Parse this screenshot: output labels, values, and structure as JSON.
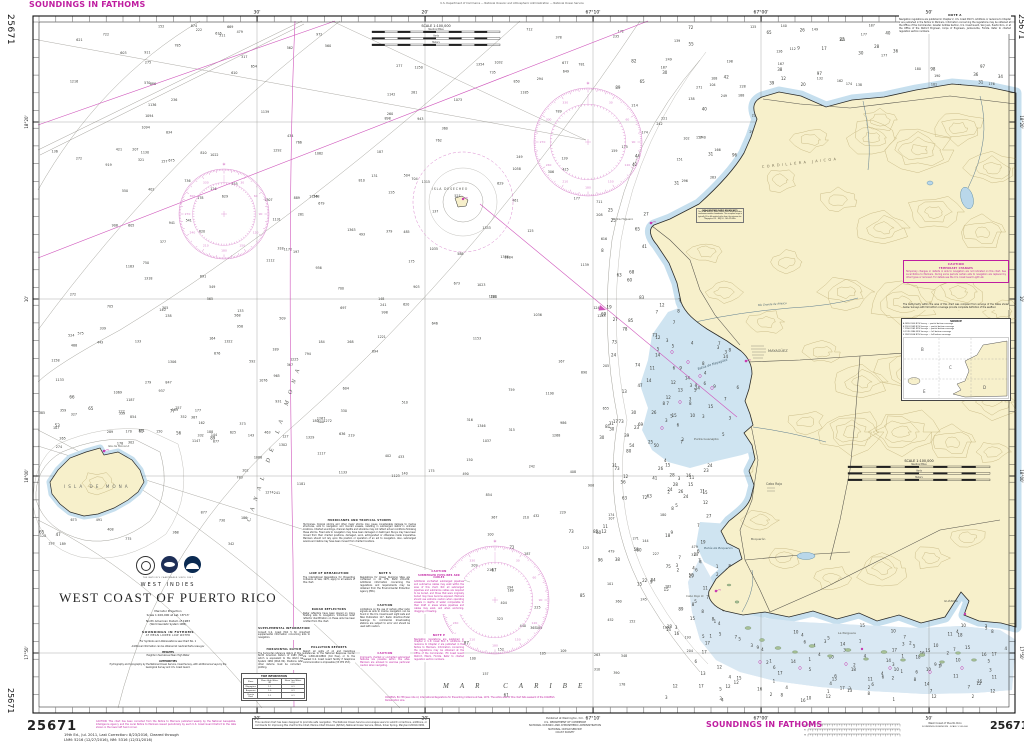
{
  "chart": {
    "number": "25671",
    "soundings_unit_label": "SOUNDINGS IN FATHOMS",
    "top_margin_note": "U.S. Department of Commerce — National Oceanic and Atmospheric Administration — National Ocean Service",
    "edition_note_line1": "19th Ed., Jul. 2011, Last Correction: 8/23/2016, Cleared through",
    "edition_note_line2": "LNM: 5216 (12/27/2016), NM: 5316 (12/31/2016)",
    "bottom_caution": "CAUTION: This chart has been corrected from the Notice to Mariners published weekly by the National Geospatial-Intelligence Agency and the Local Notice to Mariners issued periodically by each U.S. Coast Guard District to the date shown in the lower left hand corner.",
    "user_note": "This nautical chart has been designed to promote safe navigation. The National Ocean Service encourages users to submit corrections, additions, or comments for improving this chart to the Chief, Marine Chart Division (N/CS2), National Ocean Service, NOAA, Silver Spring, Maryland 20910-3282.",
    "publisher_line1": "Published at Washington, D.C.",
    "publisher_line2": "U.S. DEPARTMENT OF COMMERCE",
    "publisher_line3": "NATIONAL OCEANIC AND ATMOSPHERIC ADMINISTRATION",
    "publisher_line4": "NATIONAL OCEAN SERVICE",
    "publisher_line5": "COAST SURVEY",
    "bottom_right_title": "West Coast of Puerto Rico",
    "bottom_right_subtitle": "SOUNDINGS IN FATHOMS · SCALE 1:100,000"
  },
  "title_block": {
    "region": "WEST INDIES",
    "title": "WEST COAST OF PUERTO RICO",
    "projection": "Mercator Projection",
    "scale": "Scale 1:100,000 at Lat. 18°13'",
    "datum": "North American Datum of 1983",
    "datum2": "(World Geodetic System 1984)",
    "soundings": "SOUNDINGS IN FATHOMS",
    "soundings2": "AT MEAN LOWER LOW WATER",
    "symbols_note": "For Symbols and Abbreviations see Chart No. 1",
    "info_note": "Additional information can be obtained at nauticalcharts.noaa.gov",
    "heights_title": "HEIGHTS",
    "heights_text": "Heights in feet above Mean High Water",
    "authorities_title": "AUTHORITIES",
    "authorities_text": "Hydrography and topography by the National Ocean Service, Coast Survey, with additional surveys by the Geological Survey and U.S. Coast Guard.",
    "tagline": "THE NATION'S CHARTMAKER SINCE 1807"
  },
  "geo_labels": {
    "canal": "CANAL DE LA MONA",
    "sea": "MAR CARIBE",
    "mona_island": "ISLA DE MONA",
    "desecheo": "ISLA DESECHEO",
    "cordillera": "CORDILLERA JAICOA",
    "mayaguez_bay": "Bahía de Mayagüez",
    "boqueron_bay": "Bahía de Boquerón",
    "anasco_river": "Río Grande de Añasco",
    "mayaguez_city": "MAYAGÜEZ",
    "cabo_rojo_town": "Cabo Rojo",
    "boqueron_town": "Boquerón",
    "la_parguera": "La Parguera",
    "guanica": "GUÁNICA",
    "punta_higuero": "Punta Higuero",
    "punta_guanajibo": "Punta Guanajibo",
    "mona_light": "Isla de Mona Lt",
    "cabo_rojo_light": "Cabo Rojo Lt"
  },
  "graduation": {
    "top": [
      {
        "x": 257,
        "label": "30'"
      },
      {
        "x": 425,
        "label": "20'"
      },
      {
        "x": 593,
        "label": "67°10'"
      },
      {
        "x": 761,
        "label": "67°00'"
      },
      {
        "x": 929,
        "label": "50'"
      }
    ],
    "bottom": [
      {
        "x": 257,
        "label": "30'"
      },
      {
        "x": 425,
        "label": "20'"
      },
      {
        "x": 593,
        "label": "67°10'"
      },
      {
        "x": 761,
        "label": "67°00'"
      },
      {
        "x": 929,
        "label": "50'"
      }
    ],
    "left": [
      {
        "y": 122,
        "label": "18°20'"
      },
      {
        "y": 299,
        "label": "10'"
      },
      {
        "y": 476,
        "label": "18°00'"
      },
      {
        "y": 653,
        "label": "17°50'"
      }
    ],
    "right": [
      {
        "y": 122,
        "label": "18°20'"
      },
      {
        "y": 299,
        "label": "10'"
      },
      {
        "y": 476,
        "label": "18°00'"
      },
      {
        "y": 653,
        "label": "17°50'"
      }
    ]
  },
  "scale_bar": {
    "title": "SCALE 1:100,000",
    "rows": [
      "Nautical Miles",
      "Yards",
      "Meters"
    ]
  },
  "note_a": {
    "title": "NOTE A",
    "text": "Navigation regulations are published in Chapter 2, U.S. Coast Pilot 5. Additions or revisions to Chapter 2 are published in the Notice to Mariners. Information concerning the regulations may be obtained at the Office of the Commander, Greater Antilles Section, U.S. Coast Guard, San Juan, Puerto Rico, or at the Office of the District Engineer, Corps of Engineers, Jacksonville, Florida. Refer to charted regulation section numbers."
  },
  "caution_box": {
    "title": "CAUTION",
    "subtitle": "TEMPORARY CHANGES",
    "text": "Temporary changes or defects in aids to navigation are not indicated on this chart. See Local Notice to Mariners. During some periods certain aids to navigation are replaced by other types or removed. For details see the U.S. Coast Guard Light List."
  },
  "source_note": "The bathymetry within the area of this chart was compiled from surveys of the dates shown below. Surveys with full bottom coverage provide complete definition of the seafloor.",
  "source_diagram": {
    "title": "SOURCE",
    "entries": [
      "A   1899-1900   NOS Survey — partial bottom coverage",
      "B   1901-1949   NOS Surveys — partial bottom coverage",
      "C   1950-1969   NOS Surveys — partial bottom coverage",
      "D   1970-1986   NOS Surveys — full bottom coverage",
      "E   1987-2004   NOS Surveys — full bottom coverage"
    ]
  },
  "supplemental": {
    "title": "SUPPLEMENTAL INFORMATION",
    "text": "Consult U.S. Coast Pilot 5 for important supplemental information concerning aids to navigation."
  },
  "horizontal_datum": {
    "title": "HORIZONTAL DATUM",
    "text": "The horizontal reference datum of this chart is North American Datum of 1983 (NAD 83), which is equivalent to the World Geodetic System 1984 (WGS 84). Positions referred to other datums must be corrected before plotting."
  },
  "notes_column": {
    "hurricanes": {
      "title": "HURRICANES AND TROPICAL STORMS",
      "text": "Hurricanes, tropical storms and other major storms may cause considerable damage to marine structures, aids to navigation and moored vessels, resulting in submerged debris in unknown locations. Charted soundings, channel depths and shoreline may not reflect actual conditions following these storms. Fixed aids to navigation may have been damaged or destroyed. Buoys may have been moved from their charted positions, damaged, sunk, extinguished or otherwise made inoperative. Mariners should not rely upon the position or operation of an aid to navigation. Also, submerged wrecks and debris may have been moved from charted locations."
    },
    "demarcation": {
      "title": "LINE OF DEMARCATION",
      "text": "The International Regulations for Preventing Collisions at Sea, 1972, apply to all waters of this chart."
    },
    "radar": {
      "title": "RADAR REFLECTORS",
      "text": "Radar reflectors have been placed on many floating aids to navigation. Individual radar reflector identification on these aids has been omitted from this chart."
    },
    "pollution": {
      "title": "POLLUTION REPORTS",
      "text": "Report all spills of oil and hazardous substances to the National Response Center via 1-800-424-8802 (toll free), or to the nearest U.S. Coast Guard facility if telephone communication is impossible (33 CFR 153)."
    },
    "note_s": {
      "title": "NOTE S",
      "text": "Regulations for Ocean Dumping Sites are contained in 40 CFR, Parts 220-229. Additional information concerning the regulations and requirements may be obtained from the Environmental Protection Agency (EPA)."
    },
    "radio_caution": {
      "title": "CAUTION",
      "text": "Limitations on the use of certain other radio signals as aids to marine navigation can be found in the U.S. Coast Guard Light Lists and NGA Publication 117. Radio direction-finder bearings to commercial broadcasting stations are subject to error and should be used with caution."
    },
    "pilotage": {
      "title": "CAUTION",
      "text": "Improperly charted or uncharted submerged features are possible within this area. Mariners are advised to exercise particular caution when navigating."
    },
    "pipelines": {
      "title": "CAUTION",
      "subtitle": "SUBMERGED PIPELINES AND CABLES",
      "text": "Additional uncharted submerged pipelines and submarine cables may exist within the area of this chart. Not all submerged pipelines and submarine cables are required to be buried, and those that were originally buried may have become exposed. Mariners should use extreme caution when operating vessels in depths of water comparable to their draft in areas where pipelines and cables may exist, and when anchoring, dragging or trawling."
    },
    "note_e": {
      "title": "NOTE E",
      "text": "Navigation regulations are published in Chapter 2, U.S. Coast Pilot 5. Additions or revisions to Chapter 2 are published in the Notice to Mariners. Information concerning the regulations may be obtained at the Office of the Commander, 7th Coast Guard District, Miami, Florida. Refer to charted regulation section numbers."
    },
    "colregs": {
      "text": "COLREGS, 80.738 (see note A): International Regulations for Preventing Collisions at Sea, 1972. The entire area of this chart falls seaward of the COLREGS Demarcation Line."
    }
  },
  "tide_table": {
    "title": "TIDE INFORMATION",
    "columns": [
      "Place",
      "Mean High Water (ft)",
      "Mean Low Water (ft)"
    ],
    "rows": [
      [
        "Mayagüez",
        "1.1",
        "0.1"
      ],
      [
        "Boquerón",
        "1.0",
        "0.1"
      ],
      [
        "Puerto Real",
        "1.1",
        "0.1"
      ]
    ]
  },
  "weather_box": {
    "title": "NOAA WEATHER RADIO BROADCASTS",
    "text": "The NOAA Weather Radio station listed below provides continuous weather broadcasts. The reception range is typically 20 to 40 nautical miles from the antenna site.",
    "station": "Mayagüez, P.R. · WXJ 53 · 162.475 MHz"
  },
  "conversion_ruler": {
    "labels": [
      "Fm",
      "Ft",
      "M"
    ]
  },
  "soundings_config": {
    "seed": 1337,
    "regions": [
      {
        "x": 46,
        "y": 26,
        "w": 560,
        "h": 480,
        "count": 250,
        "min": 120,
        "max": 1400
      },
      {
        "x": 46,
        "y": 510,
        "w": 240,
        "h": 190,
        "count": 55,
        "min": 150,
        "max": 900
      },
      {
        "x": 465,
        "y": 510,
        "w": 230,
        "h": 190,
        "count": 60,
        "min": 60,
        "max": 500
      },
      {
        "x": 610,
        "y": 26,
        "w": 150,
        "h": 170,
        "count": 45,
        "min": 30,
        "max": 300
      },
      {
        "x": 600,
        "y": 200,
        "w": 58,
        "h": 390,
        "count": 55,
        "min": 6,
        "max": 90
      },
      {
        "x": 656,
        "y": 300,
        "w": 86,
        "h": 150,
        "count": 60,
        "min": 2,
        "max": 15
      },
      {
        "x": 660,
        "y": 450,
        "w": 56,
        "h": 250,
        "count": 45,
        "min": 2,
        "max": 30
      },
      {
        "x": 700,
        "y": 625,
        "w": 306,
        "h": 78,
        "count": 110,
        "min": 1,
        "max": 18
      },
      {
        "x": 690,
        "y": 560,
        "w": 40,
        "h": 65,
        "count": 18,
        "min": 1,
        "max": 10
      },
      {
        "x": 766,
        "y": 26,
        "w": 240,
        "h": 62,
        "count": 55,
        "min": 8,
        "max": 200
      },
      {
        "x": 30,
        "y": 396,
        "w": 200,
        "h": 44,
        "count": 25,
        "min": 20,
        "max": 400
      },
      {
        "x": 30,
        "y": 530,
        "w": 120,
        "h": 60,
        "count": 18,
        "min": 30,
        "max": 500
      }
    ],
    "exclusions": [
      [
        36,
        546,
        266,
        166
      ],
      [
        293,
        512,
        172,
        200
      ],
      [
        365,
        18,
        148,
        42
      ],
      [
        896,
        12,
        118,
        50
      ],
      [
        432,
        676,
        170,
        16
      ],
      [
        60,
        448,
        92,
        72
      ],
      [
        240,
        668,
        72,
        38
      ]
    ]
  }
}
